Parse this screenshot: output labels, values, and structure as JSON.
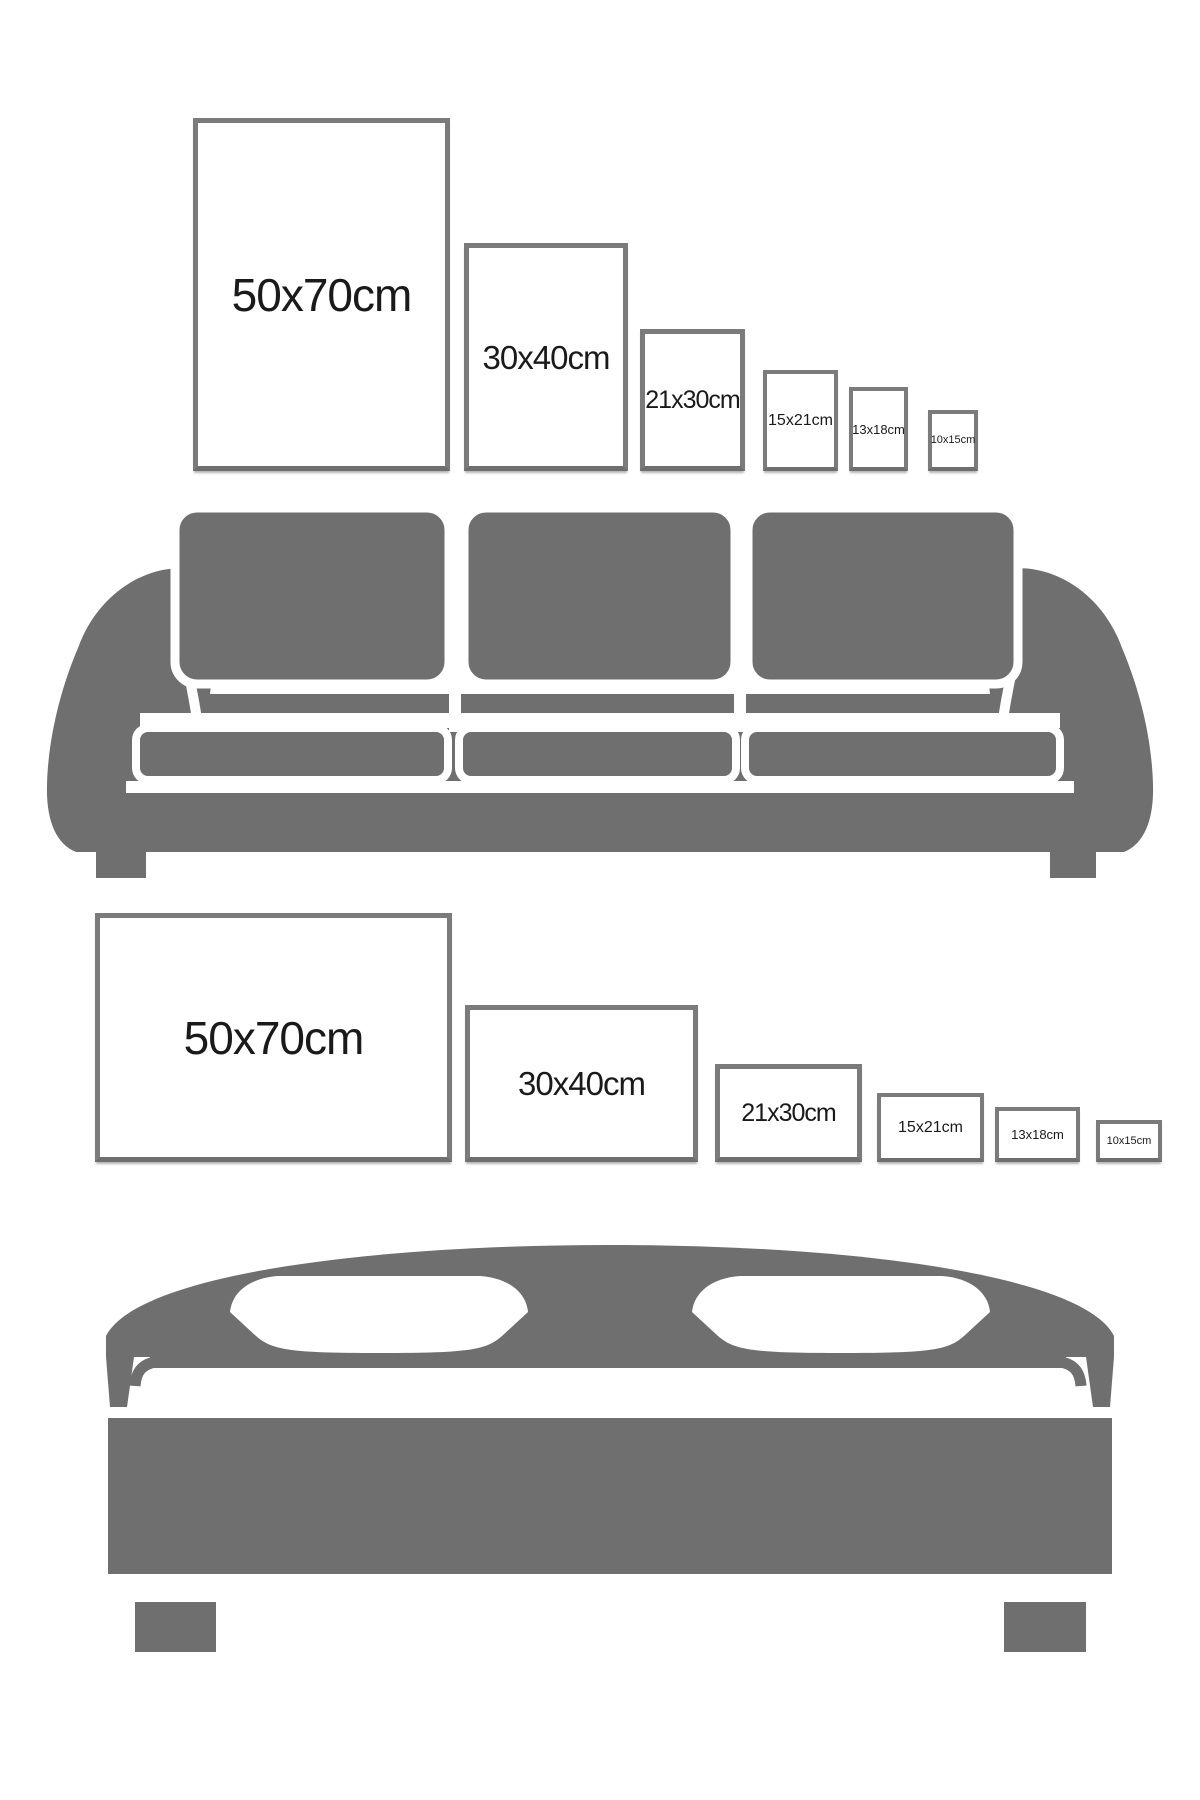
{
  "colors": {
    "background": "#ffffff",
    "furniture_gray": "#6f6f6f",
    "frame_border": "#7b7b7b",
    "label_text": "#1a1a1a",
    "seam_white": "#ffffff"
  },
  "sofa_section": {
    "frames": [
      {
        "label": "50x70cm",
        "orientation": "portrait"
      },
      {
        "label": "30x40cm",
        "orientation": "portrait"
      },
      {
        "label": "21x30cm",
        "orientation": "portrait"
      },
      {
        "label": "15x21cm",
        "orientation": "portrait"
      },
      {
        "label": "13x18cm",
        "orientation": "portrait"
      },
      {
        "label": "10x15cm",
        "orientation": "portrait"
      }
    ]
  },
  "bed_section": {
    "frames": [
      {
        "label": "50x70cm",
        "orientation": "landscape"
      },
      {
        "label": "30x40cm",
        "orientation": "landscape"
      },
      {
        "label": "21x30cm",
        "orientation": "landscape"
      },
      {
        "label": "15x21cm",
        "orientation": "landscape"
      },
      {
        "label": "13x18cm",
        "orientation": "landscape"
      },
      {
        "label": "10x15cm",
        "orientation": "landscape"
      }
    ]
  }
}
